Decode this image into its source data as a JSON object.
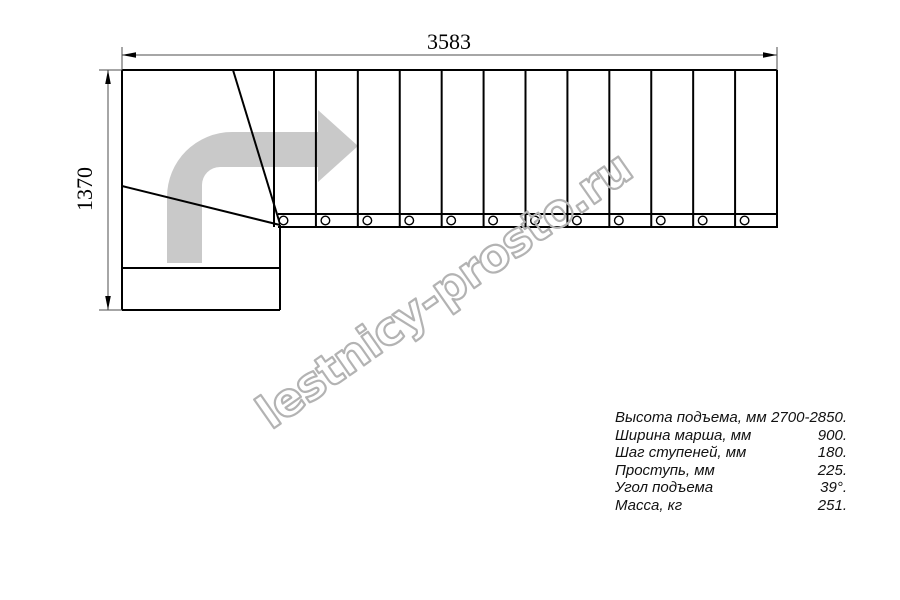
{
  "drawing": {
    "width_label": "3583",
    "height_label": "1370",
    "watermark": "lestnicy-prosto.ru",
    "flight_tread_count": 12,
    "baluster_count": 12,
    "colors": {
      "line": "#000000",
      "dimension": "#4d4d4d",
      "arrow_fill": "#c9c9c9",
      "watermark_stroke": "#b3b3b3"
    }
  },
  "specs": {
    "rows": [
      {
        "label": "Высота подъема, мм",
        "value": "2700-2850."
      },
      {
        "label": "Ширина марша, мм",
        "value": "900."
      },
      {
        "label": "Шаг ступеней, мм",
        "value": "180."
      },
      {
        "label": "Проступь, мм",
        "value": "225."
      },
      {
        "label": "Угол подъема",
        "value": "39°."
      },
      {
        "label": "Масса, кг",
        "value": "251."
      }
    ]
  }
}
